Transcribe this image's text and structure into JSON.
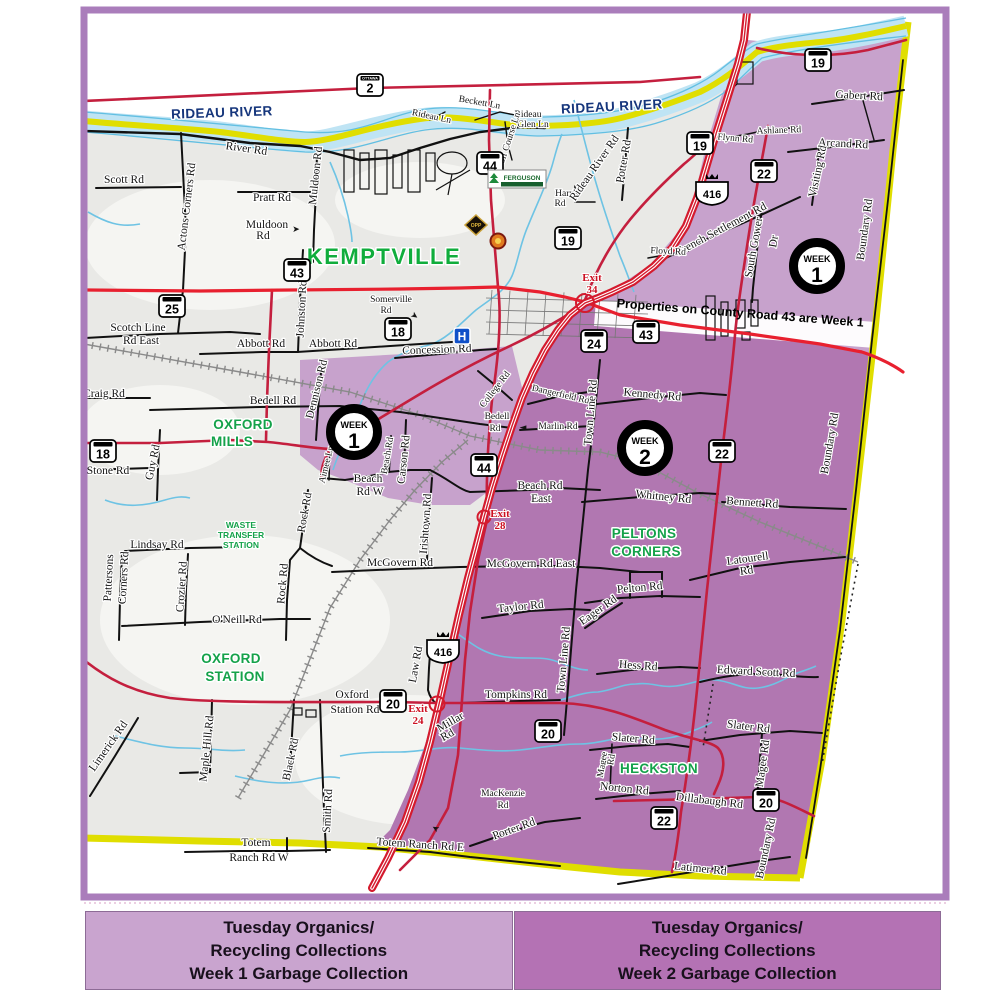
{
  "map": {
    "region_names": {
      "river": "RIDEAU RIVER",
      "note_band": "Properties on County Road 43 are Week 1"
    },
    "colors": {
      "week1_zone": "#c7a2cc",
      "week2_zone": "#b177b1",
      "boundary_yellow": "#e0de00",
      "highway_red": "#d41b2e",
      "county_red": "#c41f3e",
      "river_blue": "#bfe4f4",
      "river_edge": "#62bfe2",
      "place_green": "#14a24a",
      "frame_purple": "#aa7dbb",
      "river_label_navy": "#16367c",
      "exit_red": "#cc1122"
    },
    "labels": [
      {
        "t": "RIDEAU RIVER",
        "x": 222,
        "y": 117,
        "r": -2,
        "c": "rv"
      },
      {
        "t": "RIDEAU RIVER",
        "x": 612,
        "y": 111,
        "r": -3,
        "c": "rv"
      },
      {
        "t": "KEMPTVILLE",
        "x": 384,
        "y": 264,
        "c": "gB"
      },
      {
        "t": "OXFORD",
        "x": 243,
        "y": 429,
        "c": "g"
      },
      {
        "t": "MILLS",
        "x": 232,
        "y": 446,
        "c": "g"
      },
      {
        "t": "OXFORD",
        "x": 231,
        "y": 663,
        "c": "g"
      },
      {
        "t": "STATION",
        "x": 235,
        "y": 681,
        "c": "g"
      },
      {
        "t": "PELTONS",
        "x": 644,
        "y": 538,
        "c": "g"
      },
      {
        "t": "CORNERS",
        "x": 646,
        "y": 556,
        "c": "g"
      },
      {
        "t": "HECKSTON",
        "x": 659,
        "y": 773,
        "c": "g"
      },
      {
        "t": "WASTE",
        "x": 241,
        "y": 528,
        "c": "gs"
      },
      {
        "t": "TRANSFER",
        "x": 241,
        "y": 538,
        "c": "gs"
      },
      {
        "t": "STATION",
        "x": 241,
        "y": 548,
        "c": "gs"
      },
      {
        "t": "Properties on County Road 43 are Week 1",
        "x": 740,
        "y": 317,
        "r": 4.5,
        "c": "band"
      },
      {
        "t": "Exit",
        "x": 592,
        "y": 281,
        "c": "ex"
      },
      {
        "t": "34",
        "x": 592,
        "y": 293,
        "c": "ex"
      },
      {
        "t": "Exit",
        "x": 500,
        "y": 517,
        "c": "ex"
      },
      {
        "t": "28",
        "x": 500,
        "y": 529,
        "c": "ex"
      },
      {
        "t": "Exit",
        "x": 418,
        "y": 712,
        "c": "ex"
      },
      {
        "t": "24",
        "x": 418,
        "y": 724,
        "c": "ex"
      },
      {
        "t": "Scott Rd",
        "x": 124,
        "y": 183
      },
      {
        "t": "Actons Corners Rd",
        "x": 190,
        "y": 207,
        "r": -83
      },
      {
        "t": "River Rd",
        "x": 246,
        "y": 152,
        "r": 8
      },
      {
        "t": "Pratt Rd",
        "x": 272,
        "y": 201
      },
      {
        "t": "Muldoon",
        "x": 267,
        "y": 228
      },
      {
        "t": "Rd",
        "x": 263,
        "y": 239
      },
      {
        "t": "➤",
        "x": 296,
        "y": 232,
        "c": "ar"
      },
      {
        "t": "Muldoon Rd",
        "x": 319,
        "y": 176,
        "r": -84
      },
      {
        "t": "Rideau Ln",
        "x": 431,
        "y": 119,
        "r": 12,
        "c": "rs"
      },
      {
        "t": "Beckett Ln",
        "x": 479,
        "y": 105,
        "r": 10,
        "c": "rs"
      },
      {
        "t": "Rideau",
        "x": 528,
        "y": 117,
        "c": "rs"
      },
      {
        "t": "Glen Ln",
        "x": 533,
        "y": 127,
        "c": "rs"
      },
      {
        "t": "Golf Course Ln",
        "x": 511,
        "y": 142,
        "r": -72,
        "c": "rs"
      },
      {
        "t": "Harris",
        "x": 567,
        "y": 196,
        "c": "rs"
      },
      {
        "t": "Rd",
        "x": 560,
        "y": 206,
        "c": "rs"
      },
      {
        "t": "Rideau River Rd",
        "x": 597,
        "y": 170,
        "r": -55
      },
      {
        "t": "Potter Rd",
        "x": 627,
        "y": 162,
        "r": -80
      },
      {
        "t": "Flynn Rd",
        "x": 735,
        "y": 141,
        "r": 5,
        "c": "rs"
      },
      {
        "t": "Ashlane Rd",
        "x": 779,
        "y": 133,
        "r": -2,
        "c": "rs"
      },
      {
        "t": "Gabert Rd",
        "x": 859,
        "y": 99,
        "r": 3
      },
      {
        "t": "Arcand Rd",
        "x": 843,
        "y": 147,
        "r": 3
      },
      {
        "t": "Visiting Rd",
        "x": 821,
        "y": 172,
        "r": -78
      },
      {
        "t": "Boundary Rd",
        "x": 868,
        "y": 230,
        "r": -82
      },
      {
        "t": "French Settlement Rd",
        "x": 723,
        "y": 232,
        "r": -28
      },
      {
        "t": "Floyd Rd",
        "x": 668,
        "y": 254,
        "r": 3,
        "c": "rs"
      },
      {
        "t": "South Gower",
        "x": 757,
        "y": 248,
        "r": -80
      },
      {
        "t": "Dr",
        "x": 777,
        "y": 242,
        "r": -80
      },
      {
        "t": "Scotch Line",
        "x": 138,
        "y": 331
      },
      {
        "t": "Rd East",
        "x": 141,
        "y": 344
      },
      {
        "t": "Abbott Rd",
        "x": 261,
        "y": 347
      },
      {
        "t": "Abbott Rd",
        "x": 333,
        "y": 347
      },
      {
        "t": "Johnston Rd",
        "x": 305,
        "y": 309,
        "r": -87
      },
      {
        "t": "Somerville",
        "x": 391,
        "y": 302,
        "c": "rs"
      },
      {
        "t": "Rd",
        "x": 386,
        "y": 313,
        "c": "rs"
      },
      {
        "t": "➤",
        "x": 413,
        "y": 318,
        "r": 35,
        "c": "ar"
      },
      {
        "t": "Craig Rd",
        "x": 104,
        "y": 397
      },
      {
        "t": "Bedell Rd",
        "x": 273,
        "y": 404
      },
      {
        "t": "Dennison Rd",
        "x": 320,
        "y": 390,
        "r": -76
      },
      {
        "t": "Guy Rd",
        "x": 156,
        "y": 463,
        "r": -78
      },
      {
        "t": "Stone Rd",
        "x": 108,
        "y": 474
      },
      {
        "t": "Aimee Ln",
        "x": 329,
        "y": 465,
        "r": -76,
        "c": "rs"
      },
      {
        "t": "Beach Rd",
        "x": 390,
        "y": 456,
        "r": -80,
        "c": "rs"
      },
      {
        "t": "Carson Rd",
        "x": 407,
        "y": 460,
        "r": -84
      },
      {
        "t": "Beach",
        "x": 368,
        "y": 482
      },
      {
        "t": "Rd W",
        "x": 370,
        "y": 495
      },
      {
        "t": "Bedell",
        "x": 497,
        "y": 419,
        "c": "rs"
      },
      {
        "t": "Rd",
        "x": 495,
        "y": 431,
        "c": "rs"
      },
      {
        "t": "College Rd",
        "x": 497,
        "y": 391,
        "r": -52,
        "c": "rs"
      },
      {
        "t": "Concession Rd",
        "x": 437,
        "y": 353,
        "r": -2
      },
      {
        "t": "Beach Rd",
        "x": 540,
        "y": 489
      },
      {
        "t": "East",
        "x": 541,
        "y": 502
      },
      {
        "t": "Dangerfield Rd",
        "x": 560,
        "y": 397,
        "r": 13,
        "c": "rs"
      },
      {
        "t": "Marlin Rd",
        "x": 558,
        "y": 429,
        "c": "rs"
      },
      {
        "t": "◄",
        "x": 523,
        "y": 430,
        "c": "ar"
      },
      {
        "t": "Town Line Rd",
        "x": 594,
        "y": 413,
        "r": -85
      },
      {
        "t": "Kennedy Rd",
        "x": 652,
        "y": 398,
        "r": 5
      },
      {
        "t": "Whitney Rd",
        "x": 663,
        "y": 500,
        "r": 6
      },
      {
        "t": "Bennett Rd",
        "x": 752,
        "y": 506,
        "r": 4
      },
      {
        "t": "Latourell",
        "x": 748,
        "y": 562,
        "r": -8
      },
      {
        "t": "Rd",
        "x": 747,
        "y": 574,
        "r": -8
      },
      {
        "t": "Pelton Rd",
        "x": 640,
        "y": 591,
        "r": -5
      },
      {
        "t": "Eager Rd",
        "x": 600,
        "y": 613,
        "r": -35
      },
      {
        "t": "Taylor Rd",
        "x": 521,
        "y": 610,
        "r": -6
      },
      {
        "t": "Hess Rd",
        "x": 638,
        "y": 669,
        "r": 4
      },
      {
        "t": "Edward Scott Rd",
        "x": 756,
        "y": 675,
        "r": 3
      },
      {
        "t": "Slater Rd",
        "x": 633,
        "y": 742,
        "r": 5
      },
      {
        "t": "Slater Rd",
        "x": 748,
        "y": 730,
        "r": 7
      },
      {
        "t": "Magee",
        "x": 605,
        "y": 765,
        "r": -80,
        "c": "rs"
      },
      {
        "t": "Rd",
        "x": 614,
        "y": 760,
        "r": -80,
        "c": "rs"
      },
      {
        "t": "Magee Rd",
        "x": 766,
        "y": 764,
        "r": -82
      },
      {
        "t": "Norton Rd",
        "x": 624,
        "y": 792,
        "r": 6
      },
      {
        "t": "Dillabaugh Rd",
        "x": 709,
        "y": 804,
        "r": 7
      },
      {
        "t": "Latimer Rd",
        "x": 700,
        "y": 872,
        "r": 6
      },
      {
        "t": "Boundary Rd",
        "x": 833,
        "y": 444,
        "r": -80
      },
      {
        "t": "Boundary Rd",
        "x": 769,
        "y": 849,
        "r": -78
      },
      {
        "t": "McGovern Rd",
        "x": 400,
        "y": 566
      },
      {
        "t": "McGovern Rd East",
        "x": 531,
        "y": 567
      },
      {
        "t": "Irishtown Rd",
        "x": 429,
        "y": 524,
        "r": -86
      },
      {
        "t": "Rock Rd",
        "x": 308,
        "y": 513,
        "r": -80
      },
      {
        "t": "Rock Rd",
        "x": 286,
        "y": 584,
        "r": -85
      },
      {
        "t": "O'Neill Rd",
        "x": 237,
        "y": 623
      },
      {
        "t": "Lindsay Rd",
        "x": 157,
        "y": 548
      },
      {
        "t": "Pattersons",
        "x": 112,
        "y": 578,
        "r": -87
      },
      {
        "t": "Corners Rd",
        "x": 127,
        "y": 578,
        "r": -87
      },
      {
        "t": "Crozier Rd",
        "x": 185,
        "y": 587,
        "r": -86
      },
      {
        "t": "Oxford",
        "x": 352,
        "y": 698
      },
      {
        "t": "Station Rd",
        "x": 355,
        "y": 713
      },
      {
        "t": "Law Rd",
        "x": 419,
        "y": 665,
        "r": -80
      },
      {
        "t": "Tompkins Rd",
        "x": 516,
        "y": 698
      },
      {
        "t": "Millar",
        "x": 452,
        "y": 725,
        "r": -30
      },
      {
        "t": "Rd",
        "x": 449,
        "y": 738,
        "r": -30
      },
      {
        "t": "Town Line Rd",
        "x": 567,
        "y": 660,
        "r": -85
      },
      {
        "t": "MacKenzie",
        "x": 503,
        "y": 796,
        "c": "rs"
      },
      {
        "t": "Rd",
        "x": 503,
        "y": 808,
        "c": "rs"
      },
      {
        "t": "➤",
        "x": 437,
        "y": 826,
        "r": 210,
        "c": "ar"
      },
      {
        "t": "Porter Rd",
        "x": 515,
        "y": 832,
        "r": -20
      },
      {
        "t": "Totem Ranch Rd E",
        "x": 420,
        "y": 848,
        "r": 4
      },
      {
        "t": "Totem",
        "x": 256,
        "y": 846
      },
      {
        "t": "Ranch Rd W",
        "x": 259,
        "y": 861
      },
      {
        "t": "Limerick Rd",
        "x": 111,
        "y": 748,
        "r": -55
      },
      {
        "t": "Maple Hill Rd",
        "x": 210,
        "y": 749,
        "r": -84
      },
      {
        "t": "Black Rd",
        "x": 294,
        "y": 760,
        "r": -78
      },
      {
        "t": "Smith Rd",
        "x": 331,
        "y": 811,
        "r": -87
      }
    ],
    "shields": [
      {
        "n": "2",
        "x": 370,
        "y": 85,
        "hdr": "OTTAWA"
      },
      {
        "n": "44",
        "x": 490,
        "y": 163
      },
      {
        "n": "19",
        "x": 568,
        "y": 238
      },
      {
        "n": "19",
        "x": 700,
        "y": 143
      },
      {
        "n": "19",
        "x": 818,
        "y": 60
      },
      {
        "n": "22",
        "x": 764,
        "y": 171
      },
      {
        "n": "416",
        "x": 712,
        "y": 192,
        "p": true
      },
      {
        "n": "25",
        "x": 172,
        "y": 306
      },
      {
        "n": "43",
        "x": 297,
        "y": 270
      },
      {
        "n": "18",
        "x": 398,
        "y": 329
      },
      {
        "n": "18",
        "x": 103,
        "y": 451
      },
      {
        "n": "43",
        "x": 646,
        "y": 332
      },
      {
        "n": "24",
        "x": 594,
        "y": 341
      },
      {
        "n": "44",
        "x": 484,
        "y": 465
      },
      {
        "n": "22",
        "x": 722,
        "y": 451
      },
      {
        "n": "416",
        "x": 443,
        "y": 650,
        "p": true
      },
      {
        "n": "20",
        "x": 393,
        "y": 701
      },
      {
        "n": "20",
        "x": 548,
        "y": 731
      },
      {
        "n": "20",
        "x": 766,
        "y": 800
      },
      {
        "n": "22",
        "x": 664,
        "y": 818
      }
    ],
    "badges": [
      {
        "w": "WEEK",
        "n": "1",
        "x": 817,
        "y": 266
      },
      {
        "w": "WEEK",
        "n": "1",
        "x": 354,
        "y": 432
      },
      {
        "w": "WEEK",
        "n": "2",
        "x": 645,
        "y": 448
      }
    ],
    "icons": {
      "hospital": {
        "x": 462,
        "y": 336,
        "label": "H"
      },
      "opp_badge": {
        "x": 476,
        "y": 224,
        "label": "OPP"
      },
      "fire_crest": {
        "x": 498,
        "y": 241
      },
      "ferguson_logo": {
        "x": 517,
        "y": 179,
        "label": "FERGUSON"
      }
    }
  },
  "legend": {
    "week1": {
      "color": "#c9a4cf",
      "lines": [
        "Tuesday Organics/",
        "Recycling Collections",
        "Week 1 Garbage Collection"
      ]
    },
    "week2": {
      "color": "#b472b4",
      "lines": [
        "Tuesday Organics/",
        "Recycling Collections",
        "Week 2 Garbage Collection"
      ]
    }
  }
}
